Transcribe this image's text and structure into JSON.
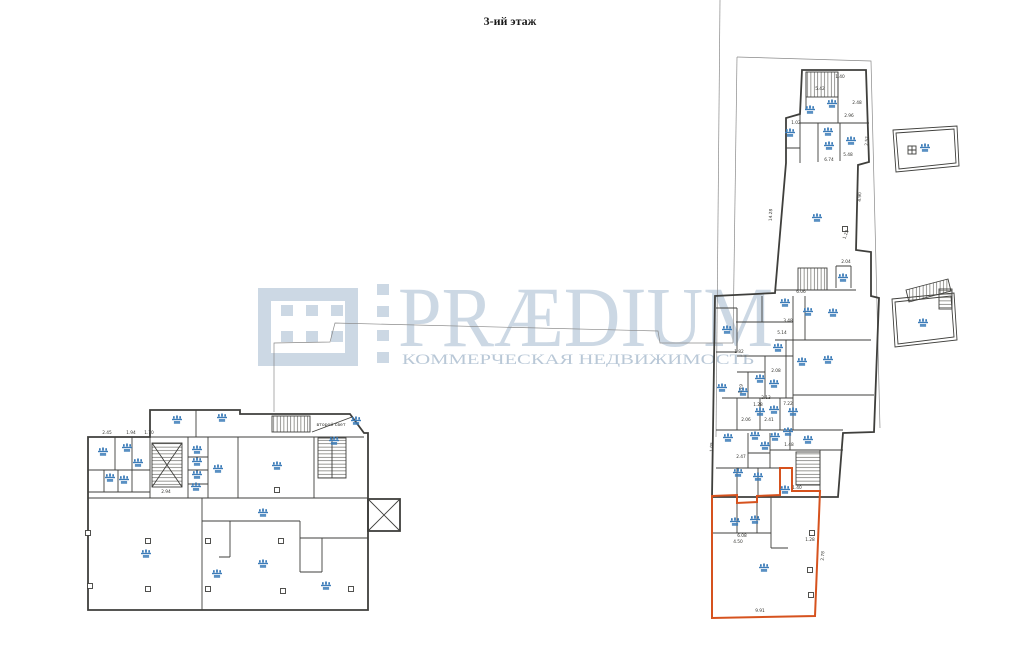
{
  "page": {
    "title": "3-ий этаж"
  },
  "watermark": {
    "brand": "PRÆDIUM",
    "tagline": "КОММЕРЧЕСКАЯ НЕДВИЖИМОСТЬ"
  },
  "plan": {
    "second_light_label": "второй свет",
    "colors": {
      "marker_blue": "#3c7cb8",
      "highlight_orange": "#d6521e",
      "watermark_blue": "#ccd8e4",
      "line_dark": "#3f3f3c"
    },
    "markers": [
      [
        103,
        452
      ],
      [
        127,
        448
      ],
      [
        138,
        463
      ],
      [
        110,
        478
      ],
      [
        124,
        480
      ],
      [
        177,
        420
      ],
      [
        222,
        418
      ],
      [
        197,
        450
      ],
      [
        197,
        462
      ],
      [
        197,
        475
      ],
      [
        196,
        487
      ],
      [
        218,
        469
      ],
      [
        277,
        466
      ],
      [
        334,
        441
      ],
      [
        356,
        421
      ],
      [
        263,
        513
      ],
      [
        146,
        554
      ],
      [
        217,
        574
      ],
      [
        263,
        564
      ],
      [
        326,
        586
      ],
      [
        832,
        104
      ],
      [
        810,
        110
      ],
      [
        790,
        133
      ],
      [
        828,
        132
      ],
      [
        829,
        146
      ],
      [
        851,
        141
      ],
      [
        817,
        218
      ],
      [
        843,
        278
      ],
      [
        785,
        303
      ],
      [
        808,
        312
      ],
      [
        833,
        313
      ],
      [
        727,
        330
      ],
      [
        778,
        348
      ],
      [
        802,
        362
      ],
      [
        828,
        360
      ],
      [
        760,
        379
      ],
      [
        774,
        384
      ],
      [
        722,
        388
      ],
      [
        743,
        392
      ],
      [
        760,
        412
      ],
      [
        774,
        410
      ],
      [
        793,
        412
      ],
      [
        728,
        438
      ],
      [
        755,
        436
      ],
      [
        775,
        437
      ],
      [
        788,
        432
      ],
      [
        765,
        446
      ],
      [
        808,
        440
      ],
      [
        738,
        473
      ],
      [
        758,
        477
      ],
      [
        785,
        490
      ],
      [
        735,
        522
      ],
      [
        755,
        520
      ],
      [
        764,
        568
      ],
      [
        925,
        148
      ],
      [
        923,
        323
      ]
    ],
    "columns": [
      [
        148,
        541
      ],
      [
        148,
        589
      ],
      [
        208,
        541
      ],
      [
        208,
        589
      ],
      [
        281,
        541
      ],
      [
        283,
        591
      ],
      [
        351,
        589
      ],
      [
        277,
        490
      ],
      [
        88,
        533
      ],
      [
        90,
        586
      ],
      [
        845,
        229
      ],
      [
        812,
        533
      ],
      [
        810,
        570
      ],
      [
        811,
        595
      ]
    ],
    "dimensions": [
      {
        "x": 107,
        "y": 434,
        "t": "2.45"
      },
      {
        "x": 131,
        "y": 434,
        "t": "1.94"
      },
      {
        "x": 149,
        "y": 434,
        "t": "1.70"
      },
      {
        "x": 166,
        "y": 493,
        "t": "2.94"
      },
      {
        "x": 840,
        "y": 78,
        "t": "1.40"
      },
      {
        "x": 820,
        "y": 90,
        "t": "5.42"
      },
      {
        "x": 849,
        "y": 117,
        "t": "2.96"
      },
      {
        "x": 857,
        "y": 104,
        "t": "2.48"
      },
      {
        "x": 848,
        "y": 156,
        "t": "5.48"
      },
      {
        "x": 829,
        "y": 161,
        "t": "6.74"
      },
      {
        "x": 796,
        "y": 124,
        "t": "1.02"
      },
      {
        "x": 868,
        "y": 141,
        "t": "2.52",
        "r": -87
      },
      {
        "x": 772,
        "y": 215,
        "t": "14.28",
        "r": -88
      },
      {
        "x": 861,
        "y": 197,
        "t": "4.90",
        "r": -88
      },
      {
        "x": 846,
        "y": 263,
        "t": "2.04"
      },
      {
        "x": 801,
        "y": 293,
        "t": "6.06"
      },
      {
        "x": 847,
        "y": 235,
        "t": "1.22",
        "r": -70
      },
      {
        "x": 788,
        "y": 322,
        "t": "3.48"
      },
      {
        "x": 782,
        "y": 334,
        "t": "5.14"
      },
      {
        "x": 739,
        "y": 353,
        "t": "1.82"
      },
      {
        "x": 776,
        "y": 372,
        "t": "2.08"
      },
      {
        "x": 766,
        "y": 399,
        "t": "2.13"
      },
      {
        "x": 788,
        "y": 405,
        "t": "7.22"
      },
      {
        "x": 742,
        "y": 389,
        "t": "1.19",
        "r": -80
      },
      {
        "x": 746,
        "y": 421,
        "t": "2.06"
      },
      {
        "x": 769,
        "y": 421,
        "t": "2.41"
      },
      {
        "x": 713,
        "y": 447,
        "t": "1.05",
        "r": -88
      },
      {
        "x": 741,
        "y": 458,
        "t": "2.47"
      },
      {
        "x": 789,
        "y": 446,
        "t": "1.48"
      },
      {
        "x": 797,
        "y": 489,
        "t": "1.40"
      },
      {
        "x": 758,
        "y": 406,
        "t": "1.28"
      },
      {
        "x": 742,
        "y": 537,
        "t": "6.08"
      },
      {
        "x": 738,
        "y": 543,
        "t": "4.50"
      },
      {
        "x": 810,
        "y": 541,
        "t": "1.28"
      },
      {
        "x": 760,
        "y": 612,
        "t": "9.91"
      },
      {
        "x": 824,
        "y": 556,
        "t": "2.78",
        "r": -85
      }
    ]
  }
}
